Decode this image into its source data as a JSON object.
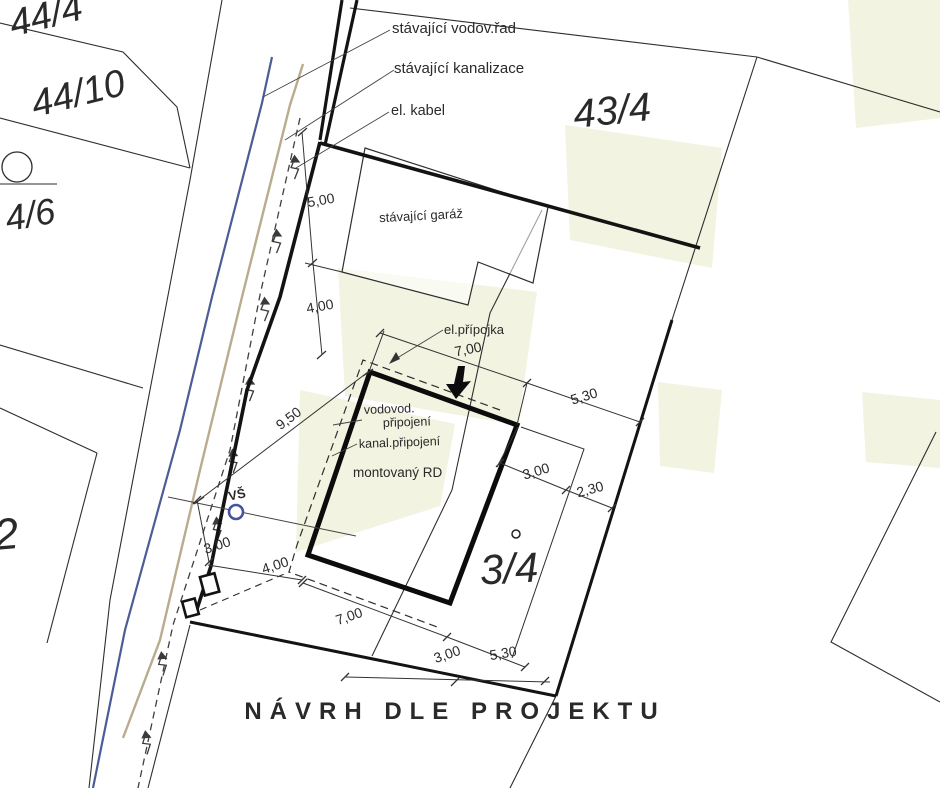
{
  "title": {
    "text": "NÁVRH DLE PROJEKTU",
    "color": "#1c4b9d"
  },
  "parcels": {
    "p44_4": "44/4",
    "p44_10": "44/10",
    "p4_6": "4/6",
    "p2": "2",
    "p43_4": "43/4",
    "p3_4": "3/4"
  },
  "legend": {
    "water_main": {
      "label": "stávající vodov.řad",
      "color": "#76849e"
    },
    "sewer": {
      "label": "stávající kanalizace",
      "color": "#aba08d"
    },
    "el_cable": {
      "label": "el. kabel",
      "color": "#3a3a3a"
    }
  },
  "features": {
    "garage": "stávající garáž",
    "house": "montovaný RD",
    "el_connection": "el.přípojka",
    "water_conn_line1": "vodovod.",
    "water_conn_line2": "připojení",
    "sewer_connection": "kanal.připojení",
    "water_shaft": "VŠ"
  },
  "dimensions": {
    "left_5_00": "5,00",
    "left_4_00": "4,00",
    "diag_9_50": "9,50",
    "top_7_00": "7,00",
    "top_5_30": "5,30",
    "east_3_00": "3,00",
    "east_2_30": "2,30",
    "road_3_00": "3,00",
    "road_4_00": "4,00",
    "bottom_7_00": "7,00",
    "bottom_3_00": "3,00",
    "bottom_5_30": "5,30"
  },
  "colors": {
    "water_line": "#4c5c95",
    "sewer_line": "#b9ab8e",
    "shaft_blue": "#44549b",
    "pale_area": "#f2f3e0",
    "line_dark": "#1a1a1a"
  }
}
